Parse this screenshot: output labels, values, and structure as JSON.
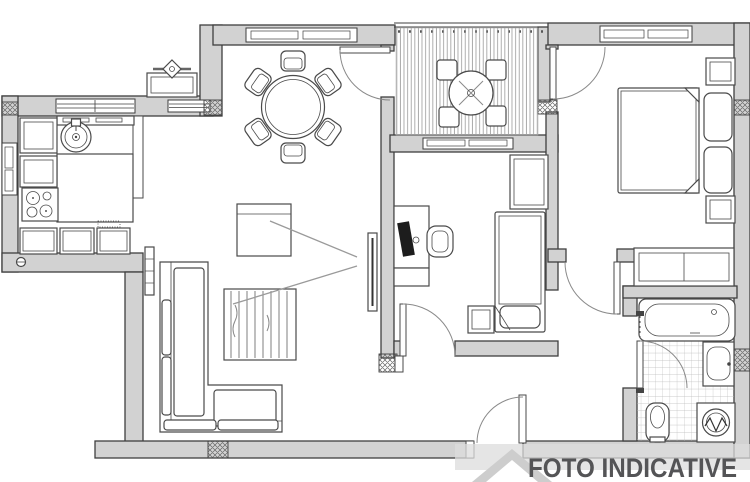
{
  "watermark": {
    "label": "FOTO INDICATIVE"
  },
  "colors": {
    "background": "#ffffff",
    "wall_fill": "#d2d2d2",
    "wall_outline": "#3f3f3f",
    "furniture_line": "#4a4a4a",
    "light_line": "#8a8a8a",
    "watermark_text": "#545456",
    "watermark_band": "#dcdcdc",
    "watermark_house_outer": "#cdcdcd",
    "watermark_house_inner": "#ffffff"
  }
}
